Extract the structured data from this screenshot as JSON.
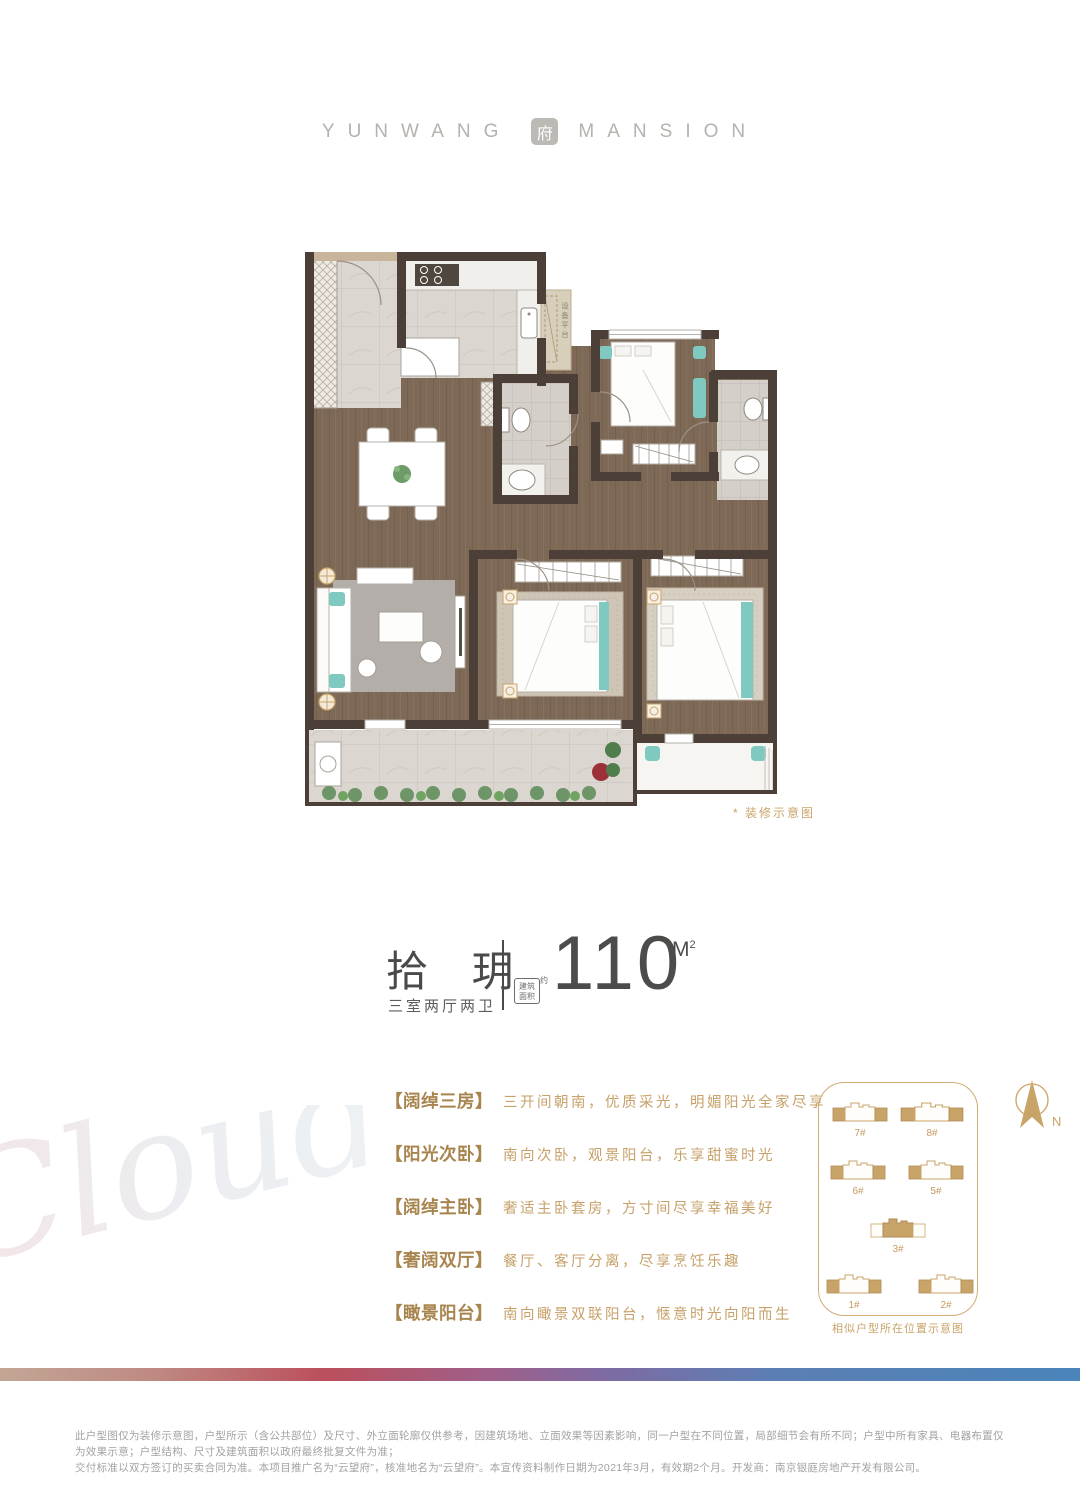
{
  "brand": {
    "left": "YUNWANG",
    "seal": "府",
    "right": "MANSION"
  },
  "floorplan": {
    "note": "* 装修示意图",
    "equipment_platform_label": "设备平台"
  },
  "unit": {
    "name": "拾 玥",
    "rooms": "三室两厅两卫",
    "stamp_line1": "建筑",
    "stamp_line2": "面积",
    "stamp_side": "约",
    "area_value": "110",
    "area_unit": "M",
    "area_sup": "2"
  },
  "features": [
    {
      "tag": "【阔绰三房】",
      "desc": "三开间朝南，优质采光，明媚阳光全家尽享"
    },
    {
      "tag": "【阳光次卧】",
      "desc": "南向次卧，观景阳台，乐享甜蜜时光"
    },
    {
      "tag": "【阔绰主卧】",
      "desc": "奢适主卧套房，方寸间尽享幸福美好"
    },
    {
      "tag": "【奢阔双厅】",
      "desc": "餐厅、客厅分离，尽享烹饪乐趣"
    },
    {
      "tag": "【瞰景阳台】",
      "desc": "南向瞰景双联阳台，惬意时光向阳而生"
    }
  ],
  "siteplan": {
    "caption": "相似户型所在位置示意图",
    "compass_label": "N",
    "buildings": [
      {
        "id": "7#",
        "highlight": false
      },
      {
        "id": "8#",
        "highlight": false
      },
      {
        "id": "6#",
        "highlight": false
      },
      {
        "id": "5#",
        "highlight": false
      },
      {
        "id": "3#",
        "highlight": true
      },
      {
        "id": "1#",
        "highlight": false
      },
      {
        "id": "2#",
        "highlight": false
      }
    ]
  },
  "watermark": "Cloud",
  "disclaimer": {
    "line1": "此户型图仅为装修示意图，户型所示（含公共部位）及尺寸、外立面轮廓仅供参考，因建筑场地、立面效果等因素影响，同一户型在不同位置，局部细节会有所不同；户型中所有家具、电器布置仅为效果示意；户型结构、尺寸及建筑面积以政府最终批复文件为准；",
    "line2": "交付标准以双方签订的买卖合同为准。本项目推广名为“云望府”，核准地名为“云望府”。本宣传资料制作日期为2021年3月，有效期2个月。开发商：南京银庭房地产开发有限公司。"
  },
  "colors": {
    "accent_gold": "#c49a62",
    "teal": "#7fc9c1",
    "wall": "#4b3f37",
    "gradient_bar": [
      "#c2a695",
      "#bb4f5c",
      "#7e6ba3",
      "#4a84ba"
    ]
  }
}
